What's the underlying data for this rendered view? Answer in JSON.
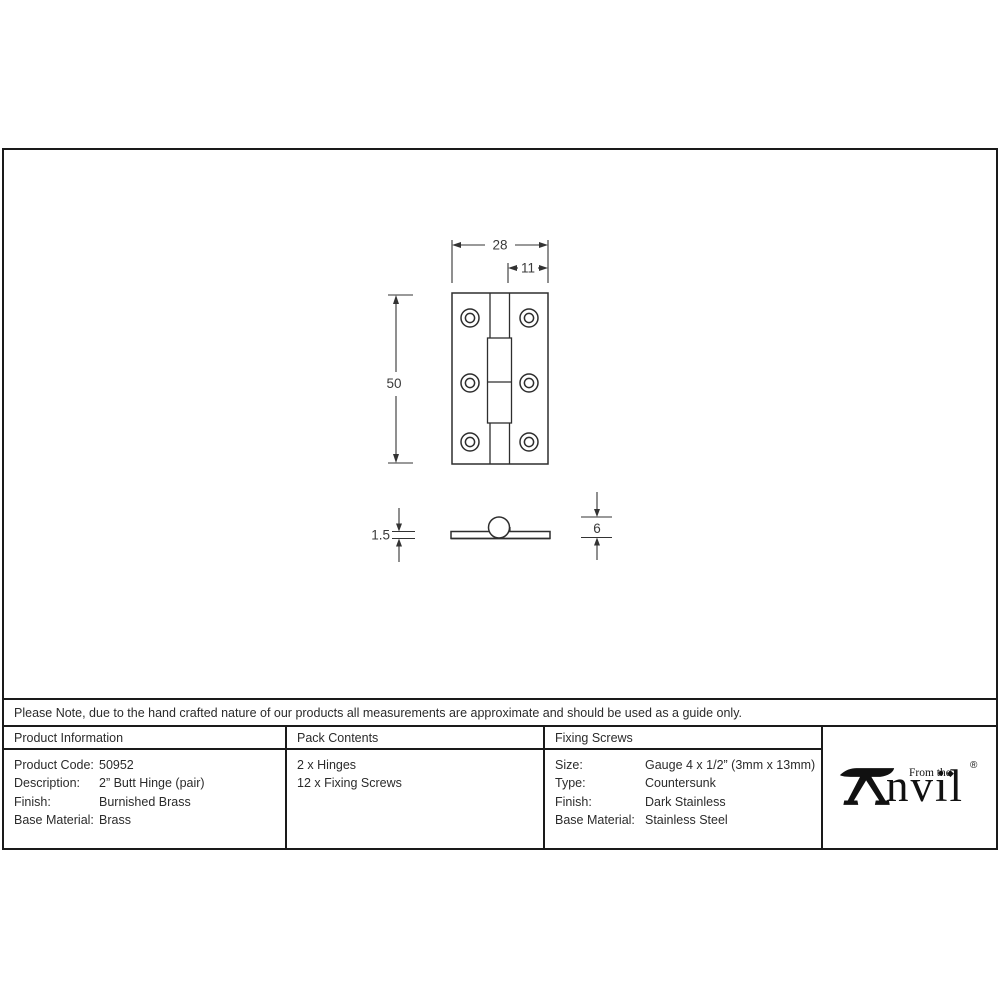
{
  "document": {
    "note": "Please Note, due to the hand crafted nature of our products all measurements are approximate and should be used as a guide only."
  },
  "drawing": {
    "front_view": {
      "width_dim": "28",
      "offset_dim": "11",
      "height_dim": "50"
    },
    "side_view": {
      "thickness_dim": "1.5",
      "knuckle_dim": "6"
    }
  },
  "table": {
    "columns": [
      {
        "header": "Product Information",
        "rows": [
          {
            "label": "Product Code:",
            "value": "50952"
          },
          {
            "label": "Description:",
            "value": "2” Butt Hinge (pair)"
          },
          {
            "label": "Finish:",
            "value": "Burnished Brass"
          },
          {
            "label": "Base Material:",
            "value": "Brass"
          }
        ]
      },
      {
        "header": "Pack Contents",
        "rows": [
          {
            "label": "2 x Hinges"
          },
          {
            "label": "12 x Fixing Screws"
          }
        ]
      },
      {
        "header": "Fixing Screws",
        "rows": [
          {
            "label": "Size:",
            "value": "Gauge 4 x 1/2” (3mm x 13mm)"
          },
          {
            "label": "Type:",
            "value": "Countersunk"
          },
          {
            "label": "Finish:",
            "value": "Dark Stainless"
          },
          {
            "label": "Base Material:",
            "value": "Stainless Steel"
          }
        ]
      }
    ]
  },
  "logo": {
    "prefix": "From the",
    "brand_suffix": "nvil",
    "diamond": "◆",
    "registered": "®"
  },
  "colors": {
    "border": "#1a1a1a",
    "drawing_line": "#333333",
    "text": "#2b2b2b"
  }
}
